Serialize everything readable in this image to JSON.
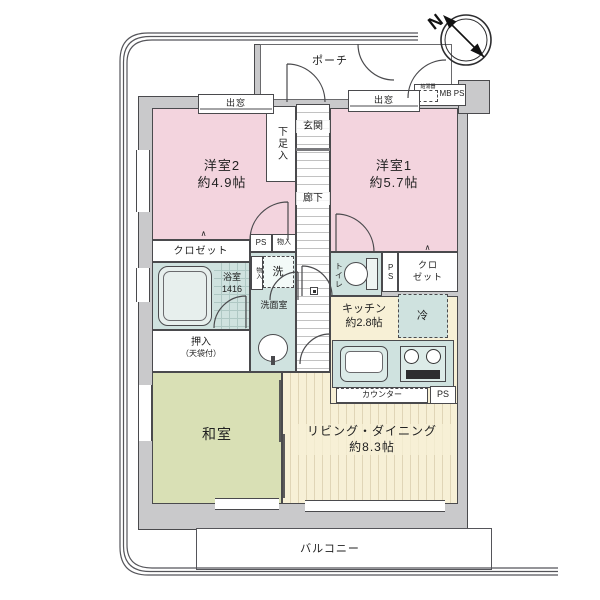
{
  "plan": {
    "compass_n": "N",
    "porch": "ポーチ",
    "water_heater": "給湯器",
    "mb_ps": "MB PS",
    "bay_left": "出窓",
    "bay_right": "出窓",
    "western2": {
      "name": "洋室2",
      "size": "約4.9帖"
    },
    "western1": {
      "name": "洋室1",
      "size": "約5.7帖"
    },
    "shoe": "下足入",
    "entrance": "玄関",
    "hallway": "廊下",
    "closet_left": "クロゼット",
    "ps_top": "PS",
    "storage_top": "物入",
    "bath": {
      "name": "浴室",
      "size": "1416"
    },
    "storage_side": "物入",
    "washer": "洗",
    "washroom": "洗面室",
    "oshiire": {
      "name": "押入",
      "note": "（天袋付）"
    },
    "toilet": "トイレ",
    "ps_mid": "PS",
    "closet_right_1": "クロ",
    "closet_right_2": "ゼット",
    "fridge": "冷",
    "kitchen": {
      "name": "キッチン",
      "size": "約2.8帖"
    },
    "counter": "カウンター",
    "ps_low": "PS",
    "japanese_room": "和室",
    "living": {
      "name": "リビング・ダイニング",
      "size": "約8.3帖"
    },
    "balcony": "バルコニー"
  },
  "colors": {
    "room_pink": "#f3d4de",
    "room_green": "#d9e0b5",
    "room_cream": "#f7f0d6",
    "wet_teal": "#cfe2df",
    "wall_gray": "#c9c9cb",
    "line": "#4a4a4d"
  }
}
